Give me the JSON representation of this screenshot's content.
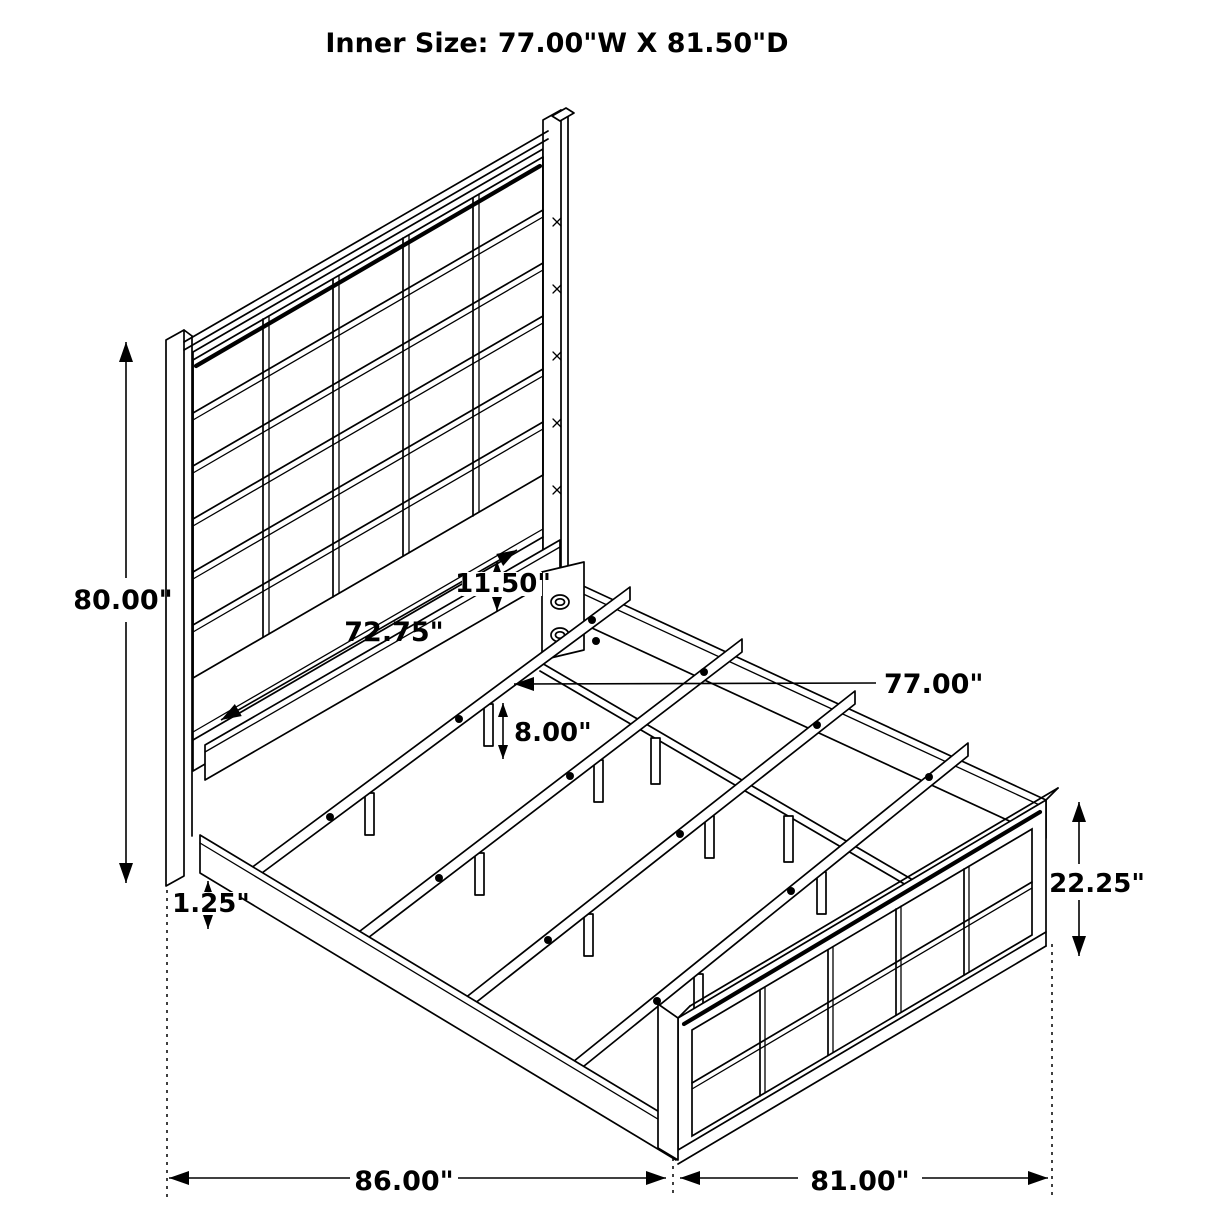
{
  "title": "Inner Size: 77.00\"W X 81.50\"D",
  "labels": {
    "headboard_height": "80.00\"",
    "headboard_inner_width": "72.75\"",
    "headboard_panel_gap": "11.50\"",
    "slat_length": "77.00\"",
    "slat_floor_height": "8.00\"",
    "rail_floor_gap": "1.25\"",
    "footboard_height": "22.25\"",
    "overall_length": "86.00\"",
    "overall_width": "81.00\""
  },
  "colors": {
    "line": "#000000",
    "background": "#ffffff",
    "text": "#000000"
  }
}
